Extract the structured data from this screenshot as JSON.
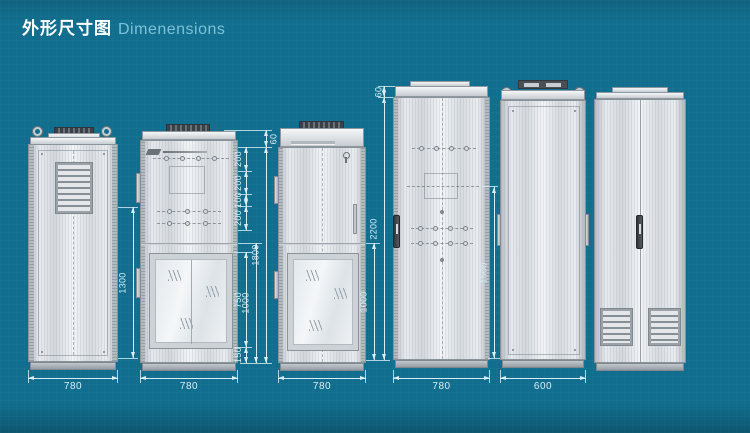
{
  "title": {
    "zh": "外形尺寸图",
    "en": "Dimenensions"
  },
  "colors": {
    "background": "#116e8e",
    "dimension_lines": "#d9edf6",
    "title_zh": "#ffffff",
    "title_en": "#7cc2d8",
    "cabinet_body": "#dfe3e7",
    "cabinet_base": "#9aa1a8"
  },
  "dims": {
    "cab1": {
      "height": "1300",
      "width": "780"
    },
    "cab2": {
      "cap": "60",
      "seg1": "200",
      "seg2": "200",
      "seg3": "100",
      "seg4": "200",
      "total": "1800",
      "door": "750",
      "lower": "1000",
      "bottom": "150",
      "width": "780"
    },
    "cab3": {
      "lower": "1000",
      "width": "780"
    },
    "cab4": {
      "cap": "60",
      "total": "2200",
      "width": "780"
    },
    "cab5": {
      "front": "1500",
      "width": "600"
    }
  }
}
